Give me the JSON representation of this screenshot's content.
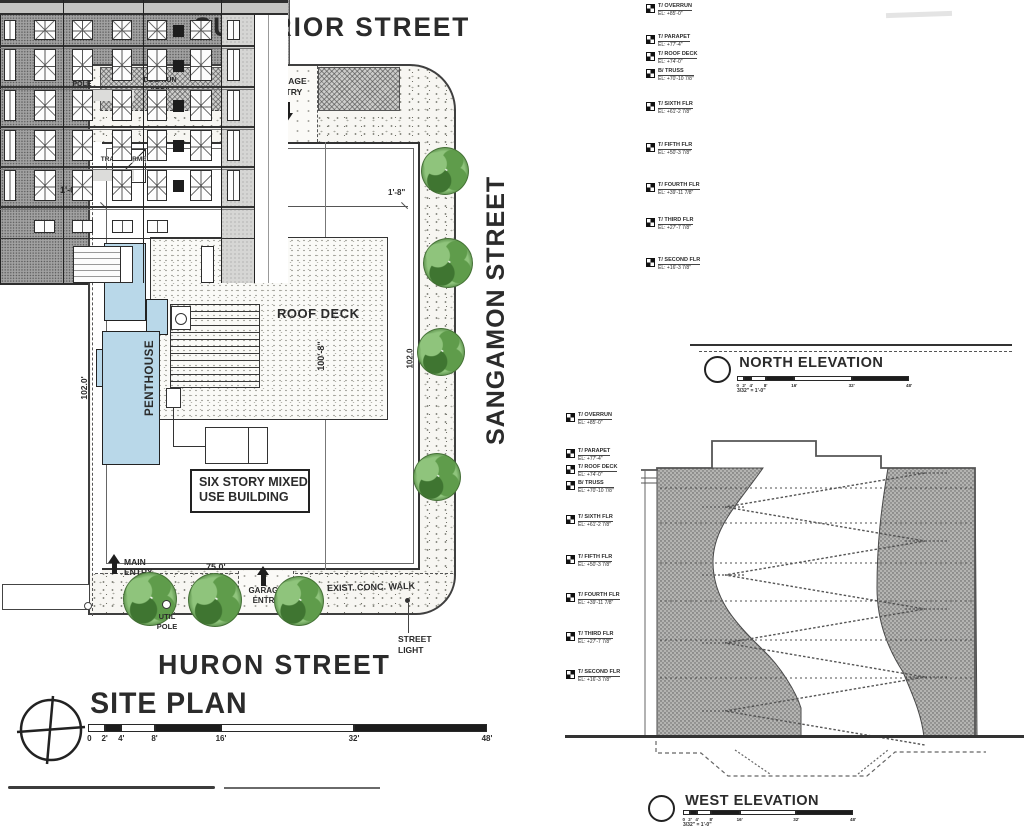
{
  "site_plan": {
    "street_top": "SUPERIOR STREET",
    "street_right": "SANGAMON STREET",
    "street_bottom": "HURON STREET",
    "title": "SITE PLAN",
    "util_pole_left": {
      "line1": "UTIL",
      "line2": "POLE"
    },
    "util_pole_mid": {
      "line1": "UTIL",
      "line2": "POLE"
    },
    "util_pole_bottom": {
      "line1": "UTIL",
      "line2": "POLE"
    },
    "dog_run": {
      "line1": "DOG RUN",
      "line2": "AREA"
    },
    "garage_entry_top": {
      "line1": "GARAGE",
      "line2": "ENTRY"
    },
    "garage_entry_bottom": {
      "line1": "GARAGE",
      "line2": "ENTRY"
    },
    "transformer": "TRANSFORMER",
    "roof_deck": "ROOF DECK",
    "penthouse": "PENTHOUSE",
    "building_label": {
      "line1": "SIX STORY MIXED",
      "line2": "USE BUILDING"
    },
    "main_entry": {
      "line1": "MAIN",
      "line2": "ENTRY"
    },
    "exist_conc_walk": "EXIST. CONC. WALK",
    "street_light": {
      "line1": "STREET",
      "line2": "LIGHT"
    },
    "dim_top": "75.0'",
    "dim_bottom": "75.0'",
    "dim_building_width": "72'-8\"",
    "dim_left_offset": "1'-0\"",
    "dim_right_offset": "1'-8\"",
    "dim_left_depth": "102.0'",
    "dim_right_depth": "102.0",
    "dim_deck_depth": "100'-8\"",
    "scale_ticks": [
      "0",
      "2'",
      "4'",
      "8'",
      "16'",
      "32'",
      "48'"
    ]
  },
  "north_elevation": {
    "title": "NORTH ELEVATION",
    "scale_ticks": [
      "0",
      "2'",
      "4'",
      "8'",
      "16'",
      "32'",
      "48'"
    ],
    "scale_note": "3/32\" = 1'-0\""
  },
  "west_elevation": {
    "title": "WEST ELEVATION",
    "scale_ticks": [
      "0",
      "2'",
      "4'",
      "8'",
      "16'",
      "32'",
      "48'"
    ],
    "scale_note": "3/32\" = 1'-0\""
  },
  "elevation_markers": [
    {
      "name": "T/ OVERRUN",
      "el": "EL: +85'-0\""
    },
    {
      "name": "T/ PARAPET",
      "el": "EL: +77'-4\""
    },
    {
      "name": "T/ ROOF DECK",
      "el": "EL: +74'-0\""
    },
    {
      "name": "B/ TRUSS",
      "el": "EL: +70'-10 7/8\""
    },
    {
      "name": "T/ SIXTH FLR",
      "el": "EL: +61'-2 7/8\""
    },
    {
      "name": "T/ FIFTH FLR",
      "el": "EL: +50'-3 7/8\""
    },
    {
      "name": "T/ FOURTH FLR",
      "el": "EL: +39'-11 7/8\""
    },
    {
      "name": "T/ THIRD FLR",
      "el": "EL: +27'-7 7/8\""
    },
    {
      "name": "T/ SECOND FLR",
      "el": "EL: +16'-3 7/8\""
    }
  ],
  "colors": {
    "ink": "#2b2b2b",
    "penthouse_blue": "#b9d8e9",
    "tree_light": "#8fc47c",
    "tree_mid": "#5f9c4b",
    "tree_dark": "#3f7531",
    "paper": "#ffffff"
  }
}
